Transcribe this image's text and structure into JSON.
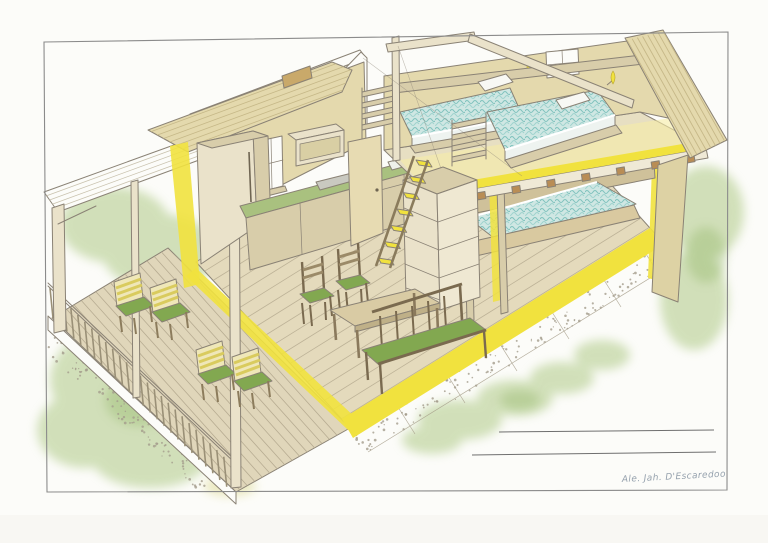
{
  "artwork": {
    "signature": "Ale. Jah. D'Escaredoo"
  },
  "palette": {
    "paper": "#fcfcf9",
    "pencil_line": "#8a8275",
    "wall_tan": "#e4d9ad",
    "wood_light": "#eae2ca",
    "wood_mid": "#d8cdaa",
    "wood_brown": "#b5935f",
    "furniture_brown": "#9b8a68",
    "mattress_teal": "#cfe7e3",
    "mattress_teal_line": "#7fc2bd",
    "highlight_yellow": "#f1e23e",
    "soft_yellow": "#f6eda6",
    "cushion_green": "#82a850",
    "foliage_green": "#aec985",
    "countertop_green": "#a9c17f",
    "gravel_gray": "#a49c8c"
  }
}
